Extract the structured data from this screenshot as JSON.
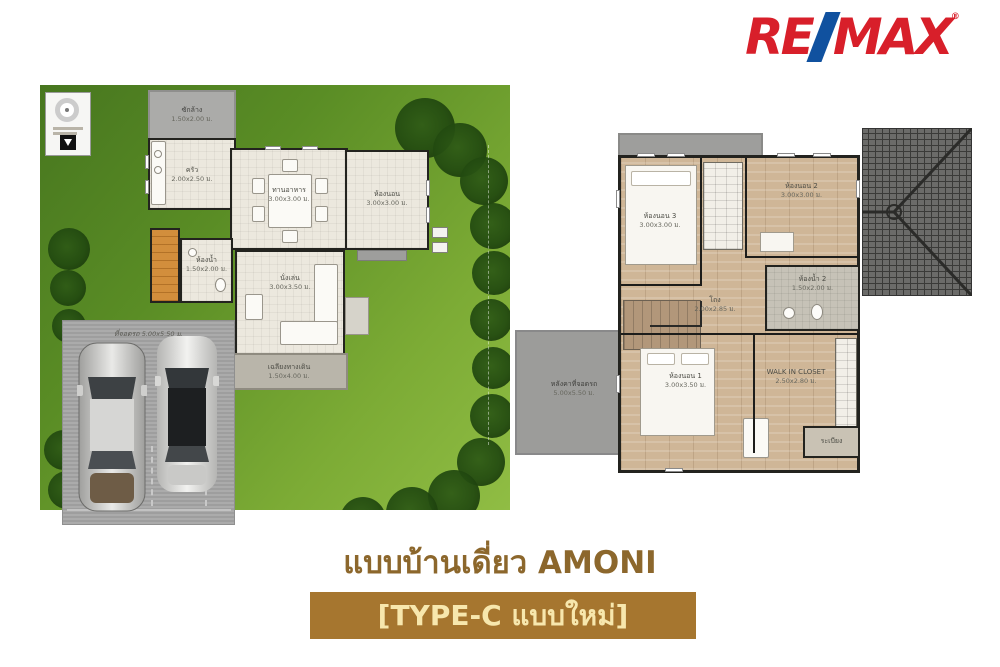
{
  "logo": {
    "re": "RE",
    "max": "MAX",
    "reg": "®",
    "red": "#D81F2A",
    "blue": "#10519F"
  },
  "title": {
    "line1": "แบบบ้านเดี่ยว AMONI",
    "line2": "[TYPE-C แบบใหม่]",
    "line1_color": "#8C672C",
    "box_bg": "#A6762F",
    "box_text_color": "#F7E7AD"
  },
  "floor1": {
    "rooms": {
      "laundry": {
        "label": "ซักล้าง",
        "dim": "1.50x2.00 ม."
      },
      "kitchen": {
        "label": "ครัว",
        "dim": "2.00x2.50 ม."
      },
      "dining": {
        "label": "ทานอาหาร",
        "dim": "3.00x3.00 ม."
      },
      "bedroom": {
        "label": "ห้องนอน",
        "dim": "3.00x3.00 ม."
      },
      "bath": {
        "label": "ห้องน้ำ",
        "dim": "1.50x2.00 ม."
      },
      "living": {
        "label": "นั่งเล่น",
        "dim": "3.00x3.50 ม."
      },
      "terrace": {
        "label": "เฉลียงทางเดิน",
        "dim": "1.50x4.00 ม."
      },
      "carport": {
        "label": "ที่จอดรถ",
        "dim": "5.00x5.50 ม."
      }
    }
  },
  "floor2": {
    "rooms": {
      "bedroom3": {
        "label": "ห้องนอน 3",
        "dim": "3.00x3.00 ม."
      },
      "bedroom2": {
        "label": "ห้องนอน 2",
        "dim": "3.00x3.00 ม."
      },
      "bath2": {
        "label": "ห้องน้ำ 2",
        "dim": "1.50x2.00 ม."
      },
      "hall": {
        "label": "โถง",
        "dim": "2.00x2.85 ม."
      },
      "bedroom1": {
        "label": "ห้องนอน 1",
        "dim": "3.00x3.50 ม."
      },
      "closet": {
        "label": "WALK IN CLOSET",
        "dim": "2.50x2.80 ม."
      },
      "balcony": {
        "label": "ระเบียง"
      },
      "carport_roof": {
        "label": "หลังคาที่จอดรถ",
        "dim": "5.00x5.50 ม."
      }
    }
  }
}
